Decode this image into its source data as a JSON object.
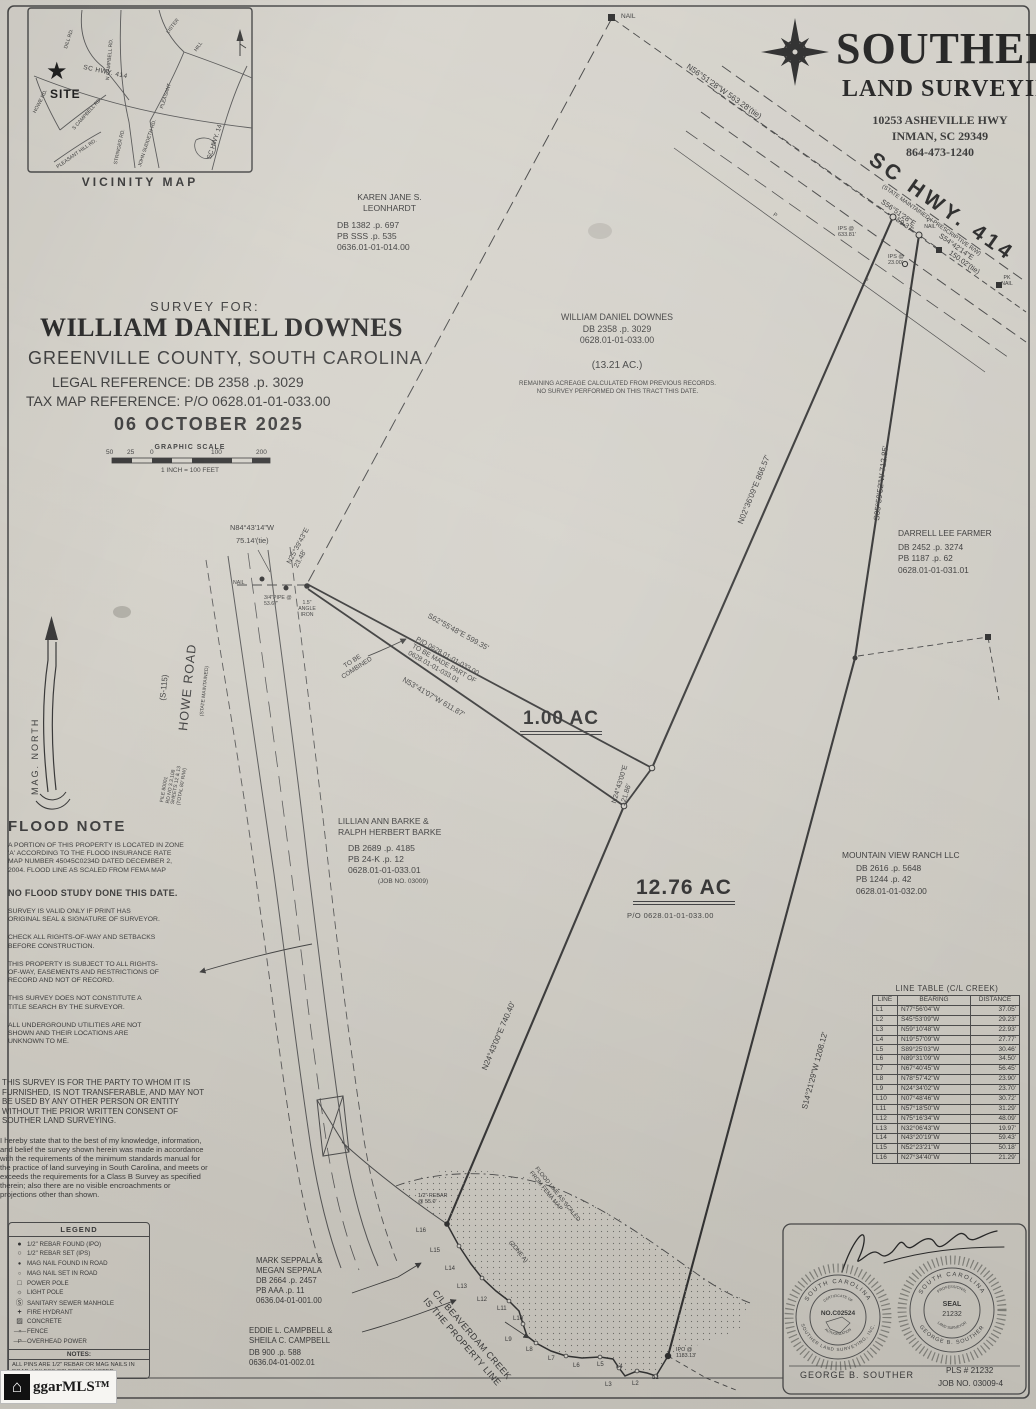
{
  "firm": {
    "name": "SOUTHER",
    "tagline": "LAND SURVEYING",
    "address": "10253 ASHEVILLE HWY",
    "city": "INMAN, SC 29349",
    "phone": "864-473-1240"
  },
  "vicinity": {
    "caption": "VICINITY MAP",
    "site": "SITE",
    "roads": {
      "dill": "DILL RD.",
      "n_campbell": "N CAMPBELL RD.",
      "lister": "LISTER",
      "pleasant": "PLEASANT",
      "hill": "HILL",
      "hwy414": "SC HWY. 414",
      "hwy14": "SC HWY. 14",
      "howe": "HOWE RD.",
      "s_campbell": "S CAMPBELL RD.",
      "pleasant_hill_rd": "PLEASANT HILL RD.",
      "stringer": "STRINGER RD.",
      "john_suddeth": "JOHN SUDDETH RD."
    }
  },
  "title_block": {
    "survey_for": "SURVEY FOR:",
    "client": "WILLIAM DANIEL DOWNES",
    "location": "GREENVILLE COUNTY, SOUTH CAROLINA",
    "legal_reference": "LEGAL REFERENCE: DB 2358 .p. 3029",
    "tax_map_reference": "TAX MAP REFERENCE: P/O 0628.01-01-033.00",
    "date": "06 OCTOBER 2025",
    "scale_title": "GRAPHIC SCALE",
    "scale_ticks": [
      "50",
      "25",
      "0",
      "100",
      "200"
    ],
    "scale_note": "1 INCH = 100 FEET"
  },
  "owners": {
    "leonhardt": {
      "name1": "KAREN JANE S.",
      "name2": "LEONHARDT",
      "db": "DB 1382 .p. 697",
      "pb": "PB SSS .p. 535",
      "tms": "0636.01-01-014.00"
    },
    "downes": {
      "name": "WILLIAM DANIEL DOWNES",
      "db": "DB 2358 .p. 3029",
      "tms": "0628.01-01-033.00",
      "area": "(13.21 AC.)",
      "note1": "REMAINING ACREAGE CALCULATED FROM PREVIOUS RECORDS.",
      "note2": "NO SURVEY PERFORMED ON THIS TRACT THIS DATE."
    },
    "farmer": {
      "name": "DARRELL LEE FARMER",
      "db": "DB 2452 .p. 3274",
      "pb": "PB 1187 .p. 62",
      "tms": "0628.01-01-031.01"
    },
    "barke": {
      "name1": "LILLIAN ANN BARKE &",
      "name2": "RALPH HERBERT BARKE",
      "db": "DB 2689 .p. 4185",
      "pb": "PB 24-K .p. 12",
      "tms": "0628.01-01-033.01",
      "job": "(JOB NO. 03009)"
    },
    "mountain_view": {
      "name": "MOUNTAIN VIEW RANCH LLC",
      "db": "DB 2616 .p. 5648",
      "pb": "PB 1244 .p. 42",
      "tms": "0628.01-01-032.00"
    },
    "seppala": {
      "name1": "MARK SEPPALA &",
      "name2": "MEGAN SEPPALA",
      "db": "DB 2664 .p. 2457",
      "pb": "PB AAA .p. 11",
      "tms": "0636.04-01-001.00"
    },
    "campbell": {
      "name1": "EDDIE L. CAMPBELL &",
      "name2": "SHEILA C. CAMPBELL",
      "db": "DB 900 .p. 588",
      "tms": "0636.04-01-002.01"
    }
  },
  "tracts": {
    "a": "1.00 AC",
    "b": "12.76 AC",
    "b_parcel": "P/O 0628.01-01-033.00"
  },
  "map_labels": {
    "nail_top": "NAIL",
    "tie_top": "N56°51'28\"W  563.28'(tie)",
    "hwy_name": "SC HWY. 414",
    "hwy_note": "(STATE MAINTAINED - PRESCRIPTIVE R/W)",
    "hwy_brg1": "S56°51'28\"E",
    "hwy_dist1": "59.37'",
    "hwy_brg2": "S54°42'14\"E",
    "hwy_dist2": "150.02'(tie)",
    "pk_nail": "PK NAIL",
    "ips_a": "IPS @ 633.81'",
    "ips_b": "IPS @ 23.00'",
    "brg_ne": "N02°36'09\"E  866.57'",
    "brg_e": "S05°59'52\"W  712.85'",
    "brg_se": "S14°21'29\"W  1208.12'",
    "brg_w": "N24°43'00\"E  740.40'",
    "tie_nw_1": "N84°43'14\"W",
    "tie_nw_2": "75.14'(tie)",
    "tie_nw_3": "N25°39'43\"E",
    "tie_nw_4": "23.48'",
    "nail_road": "NAIL",
    "pipe": "3/4\"PIPE @ 53.67'",
    "angle_iron": "1.5\" ANGLE IRON",
    "wedge_top": "S62°55'48\"E  599.35'",
    "wedge_po1": "P/O 0628.01-01-033.00",
    "wedge_po2": "TO BE MADE PART OF",
    "wedge_po3": "0628.01-01-033.01",
    "wedge_bottom": "N53°41'07\"W  611.87'",
    "combine1": "TO BE",
    "combine2": "COMBINED",
    "wedge_right_brg": "N24°43'00\"E",
    "wedge_right_dist": "121.86'",
    "howe": "HOWE ROAD",
    "howe_no": "(S-115)",
    "howe_note": "(STATE MAINTAINED)",
    "road_file1": "FILE 80001",
    "road_file2": "RD NO 3.3.108",
    "road_file3": "SHEETS 12 & 13",
    "road_file4": "(TOTAL 80' R/W)",
    "mag_north": "MAG. NORTH",
    "creek1": "C/L BEAVERDAM CREEK",
    "creek2": "IS THE PROPERTY LINE",
    "flood1": "FLOOD LINE AS SCALED",
    "flood2": "FROM FEMA MAP",
    "zone": "(ZONE A)",
    "rebar": "1/2\" REBAR",
    "rebar_d": "@ 55.0'",
    "ipo1": "IPO @",
    "ipo2": "1183.13'",
    "p": "P"
  },
  "flood_note": {
    "title": "FLOOD NOTE",
    "body": "A PORTION OF THIS PROPERTY IS LOCATED IN ZONE 'A' ACCORDING TO THE FLOOD INSURANCE RATE MAP NUMBER 45045C0234D DATED DECEMBER 2, 2004. FLOOD LINE AS SCALED FROM FEMA MAP",
    "emphasis": "NO FLOOD STUDY DONE THIS DATE."
  },
  "general_notes": [
    "SURVEY IS VALID ONLY IF PRINT HAS ORIGINAL SEAL & SIGNATURE OF SURVEYOR.",
    "CHECK ALL RIGHTS-OF-WAY AND SETBACKS BEFORE CONSTRUCTION.",
    "THIS PROPERTY IS SUBJECT TO ALL RIGHTS-OF-WAY, EASEMENTS AND RESTRICTIONS OF RECORD AND NOT OF RECORD.",
    "THIS SURVEY DOES NOT CONSTITUTE A TITLE SEARCH BY THE SURVEYOR.",
    "ALL UNDERGROUND UTILITIES ARE NOT SHOWN AND THEIR LOCATIONS ARE UNKNOWN TO ME."
  ],
  "transfer_note": "THIS SURVEY IS FOR THE PARTY TO WHOM IT IS FURNISHED, IS NOT TRANSFERABLE, AND MAY NOT BE USED BY ANY OTHER PERSON OR ENTITY WITHOUT THE PRIOR WRITTEN CONSENT OF SOUTHER LAND SURVEYING.",
  "certification": "I hereby state that to the best of my knowledge, information, and belief the survey shown herein was made in accordance with the requirements of the minimum standards manual for the practice of land surveying in South Carolina, and meets or exceeds the requirements for a Class B Survey as specified therein; also there are no visible encroachments or projections other than shown.",
  "legend": {
    "title": "LEGEND",
    "items": [
      {
        "icon": "ipo-circle",
        "label": "1/2\" REBAR FOUND (IPO)"
      },
      {
        "icon": "ips-circle",
        "label": "1/2\" REBAR SET (IPS)"
      },
      {
        "icon": "magnail-found",
        "label": "MAG NAIL FOUND IN ROAD"
      },
      {
        "icon": "magnail-set",
        "label": "MAG NAIL SET IN ROAD"
      },
      {
        "icon": "power-pole",
        "label": "POWER POLE"
      },
      {
        "icon": "light-pole",
        "label": "LIGHT POLE"
      },
      {
        "icon": "manhole",
        "label": "SANITARY SEWER MANHOLE"
      },
      {
        "icon": "fire-hydrant",
        "label": "FIRE HYDRANT"
      },
      {
        "icon": "concrete",
        "label": "CONCRETE"
      },
      {
        "icon": "fence",
        "label": "FENCE"
      },
      {
        "icon": "overhead-power",
        "label": "OVERHEAD POWER"
      }
    ],
    "notes_title": "NOTES:",
    "notes": "ALL PINS ARE 1/2\" REBAR OR MAG NAILS IN ROAD, UNLESS OTHERWISE NOTED."
  },
  "line_table": {
    "title": "LINE TABLE (C/L CREEK)",
    "headers": [
      "LINE",
      "BEARING",
      "DISTANCE"
    ],
    "rows": [
      [
        "L1",
        "N77°56'04\"W",
        "37.05'"
      ],
      [
        "L2",
        "S45°53'09\"W",
        "29.23'"
      ],
      [
        "L3",
        "N59°10'48\"W",
        "22.93'"
      ],
      [
        "L4",
        "N19°57'09\"W",
        "27.77'"
      ],
      [
        "L5",
        "S89°25'03\"W",
        "30.46'"
      ],
      [
        "L6",
        "N89°31'09\"W",
        "34.50'"
      ],
      [
        "L7",
        "N67°40'45\"W",
        "56.45'"
      ],
      [
        "L8",
        "N78°57'42\"W",
        "23.90'"
      ],
      [
        "L9",
        "N24°34'02\"W",
        "23.70'"
      ],
      [
        "L10",
        "N07°48'46\"W",
        "30.72'"
      ],
      [
        "L11",
        "N57°18'50\"W",
        "31.29'"
      ],
      [
        "L12",
        "N75°16'34\"W",
        "48.09'"
      ],
      [
        "L13",
        "N32°06'43\"W",
        "19.97'"
      ],
      [
        "L14",
        "N43°20'19\"W",
        "59.43'"
      ],
      [
        "L15",
        "N52°23'21\"W",
        "50.18'"
      ],
      [
        "L16",
        "N27°34'40\"W",
        "21.29'"
      ]
    ]
  },
  "seal_block": {
    "auth_top": "SOUTH CAROLINA",
    "auth_cert": "CERTIFICATE OF",
    "auth_no": "NO.C02524",
    "auth_bottom": "AUTHORIZATION",
    "auth_ring": "SOUTHER LAND SURVEYING, INC.",
    "pls_top": "SOUTH CAROLINA",
    "pls_prof": "PROFESSIONAL",
    "pls_seal": "SEAL",
    "pls_no": "21232",
    "pls_ls": "LAND SURVEYOR",
    "pls_ring": "GEORGE B. SOUTHER",
    "surveyor": "GEORGE B. SOUTHER",
    "pls_number": "PLS # 21232",
    "job_no": "JOB NO. 03009-4"
  },
  "watermark": "ggarMLS™"
}
